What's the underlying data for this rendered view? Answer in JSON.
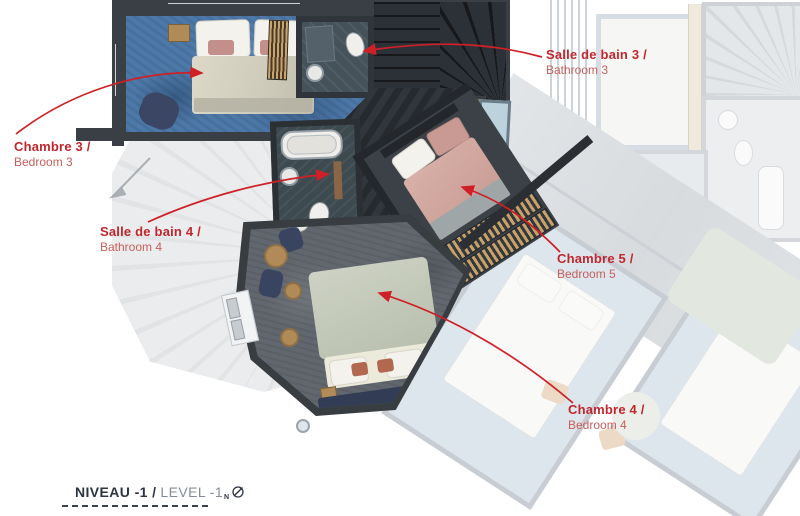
{
  "plan": {
    "name": "apartment-floor-plan-level-minus-1"
  },
  "colors": {
    "annotation_red": "#c0272d",
    "annotation_red_light": "#c75f5b",
    "wall_dark": "#3a3f45",
    "carpet_blue": "#4d79a9",
    "carpet_grey": "#61676e",
    "footer_dark": "#2c3540",
    "footer_light": "#848d97"
  },
  "annotations": [
    {
      "id": "bedroom-3",
      "label_fr": "Chambre 3 /",
      "label_en": "Bedroom 3"
    },
    {
      "id": "bathroom-3",
      "label_fr": "Salle de bain 3 /",
      "label_en": "Bathroom 3"
    },
    {
      "id": "bathroom-4",
      "label_fr": "Salle de bain 4 /",
      "label_en": "Bathroom 4"
    },
    {
      "id": "bedroom-5",
      "label_fr": "Chambre 5 /",
      "label_en": "Bedroom 5"
    },
    {
      "id": "bedroom-4",
      "label_fr": "Chambre 4 /",
      "label_en": "Bedroom 4"
    }
  ],
  "footer": {
    "level_fr": "NIVEAU -1 /",
    "level_en": "LEVEL -1",
    "compass_letter": "N"
  }
}
